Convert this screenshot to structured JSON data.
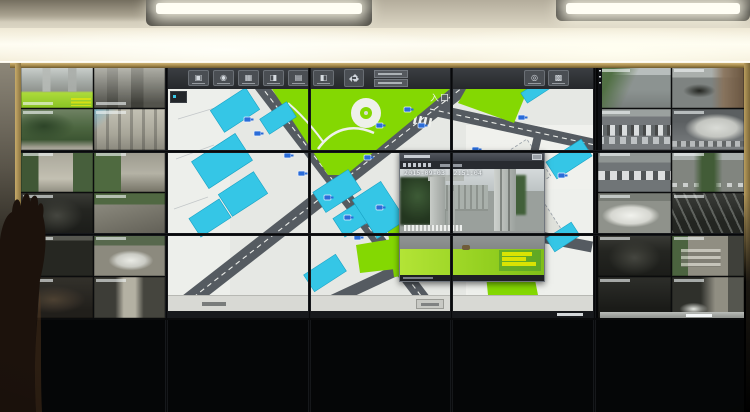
{
  "video_wall": {
    "left_feeds": [
      {
        "id": "L01",
        "scene": "gate-lawn",
        "osd": "b",
        "ymini": true
      },
      {
        "id": "L02",
        "scene": "alley-buildings",
        "osd": "b"
      },
      {
        "id": "L03",
        "scene": "green-courtyard",
        "osd": "t"
      },
      {
        "id": "L04",
        "scene": "building-wall",
        "osd": "t"
      },
      {
        "id": "L05",
        "scene": "paved-path",
        "osd": "t"
      },
      {
        "id": "L06",
        "scene": "leafy-lane",
        "osd": "t"
      },
      {
        "id": "L07",
        "scene": "garage-dark",
        "osd": "t"
      },
      {
        "id": "L08",
        "scene": "driveway",
        "osd": "t"
      },
      {
        "id": "L09",
        "scene": "garage-dark2",
        "osd": "t"
      },
      {
        "id": "L10",
        "scene": "white-car",
        "osd": "t"
      },
      {
        "id": "L11",
        "scene": "dark-storefront",
        "osd": "t"
      },
      {
        "id": "L12",
        "scene": "narrow-alley",
        "osd": "t"
      }
    ],
    "right_feeds": [
      {
        "id": "R01",
        "scene": "street-grass",
        "osd": "t"
      },
      {
        "id": "R02",
        "scene": "street-shop",
        "osd": "t"
      },
      {
        "id": "R03",
        "scene": "parking-lot",
        "osd": "t"
      },
      {
        "id": "R04",
        "scene": "curved-roof",
        "osd": "t"
      },
      {
        "id": "R05",
        "scene": "cars-row",
        "osd": "t"
      },
      {
        "id": "R06",
        "scene": "tree-street",
        "osd": "t"
      },
      {
        "id": "R07",
        "scene": "white-car-close",
        "osd": "t"
      },
      {
        "id": "R08",
        "scene": "stairwell-dark",
        "osd": "t"
      },
      {
        "id": "R09",
        "scene": "garage-dark",
        "osd": "t"
      },
      {
        "id": "R10",
        "scene": "stairs-outdoor",
        "osd": "t"
      },
      {
        "id": "R11",
        "scene": "dark-entry",
        "osd": "t"
      },
      {
        "id": "R12",
        "scene": "alley-car",
        "osd": "t"
      }
    ]
  },
  "map_app": {
    "toolbar": {
      "icons": [
        {
          "name": "monitor-icon",
          "glyph": "▣"
        },
        {
          "name": "camera-icon",
          "glyph": "◉"
        },
        {
          "name": "grid-view-icon",
          "glyph": "▦"
        },
        {
          "name": "split-screen-icon",
          "glyph": "◨"
        },
        {
          "name": "document-icon",
          "glyph": "▤"
        },
        {
          "name": "operator-icon",
          "glyph": "◧"
        }
      ],
      "right_icons": [
        {
          "name": "compass-icon",
          "glyph": "◎"
        },
        {
          "name": "layers-icon",
          "glyph": "▩"
        }
      ]
    },
    "road_label": "入口"
  },
  "popup": {
    "timestamp": "2015-09-03 12:51:04"
  },
  "colors": {
    "map_green": "#84d802",
    "map_cyan": "#35c6e6",
    "map_road": "#555b61",
    "lawn_bright": "#a8da2c",
    "caption_yellow": "#e6ea00"
  }
}
